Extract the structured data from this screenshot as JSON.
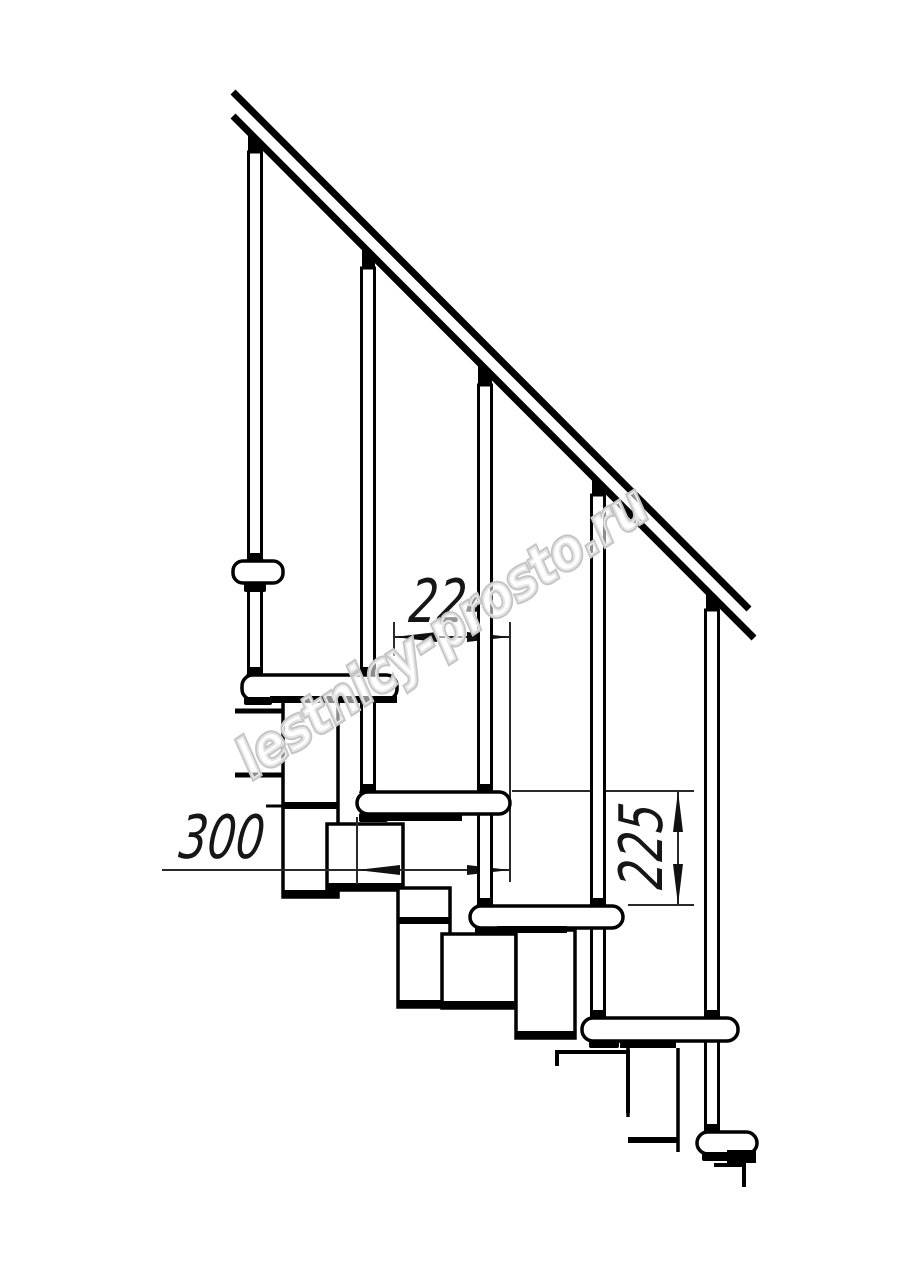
{
  "drawing": {
    "type": "staircase-modular-side-view-technical-drawing",
    "background_color": "#ffffff",
    "line_color": "#000000",
    "dimension_line_color": "#2a2a2a",
    "dimensions": [
      {
        "id": "step-run",
        "value": "224",
        "orientation": "horizontal"
      },
      {
        "id": "tread-depth",
        "value": "300",
        "orientation": "horizontal"
      },
      {
        "id": "step-rise",
        "value": "225",
        "orientation": "vertical"
      }
    ],
    "watermark": {
      "text": "lestnicy-prosto.ru",
      "color": "#c5c5c5"
    },
    "components": {
      "treads_visible": 5,
      "balusters_visible": 5,
      "handrail": "diagonal double line, upper left to lower right"
    }
  }
}
